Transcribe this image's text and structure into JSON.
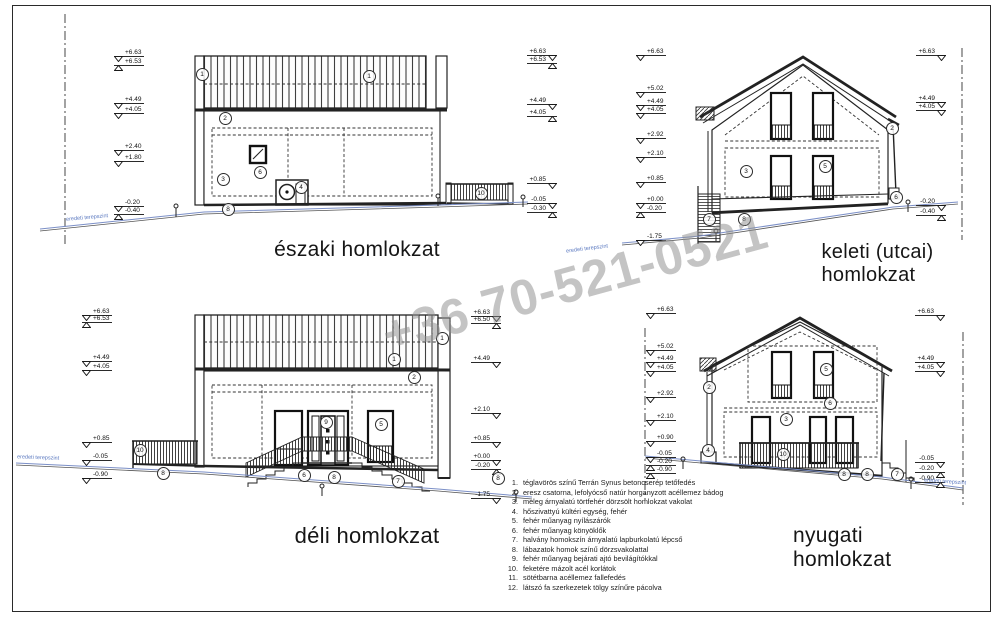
{
  "watermark": {
    "text": "+36 70-521-0521"
  },
  "ground_label": "eredeti terepszint",
  "elevations": [
    {
      "id": "eszaki",
      "label": "északi homlokzat",
      "levels_left": [
        {
          "v": "+6.63",
          "t": "d",
          "y": 47
        },
        {
          "v": "+6.53",
          "t": "u",
          "y": 56
        },
        {
          "v": "+4.49",
          "t": "d",
          "y": 94
        },
        {
          "v": "+4.05",
          "t": "d",
          "y": 104
        },
        {
          "v": "+2.40",
          "t": "d",
          "y": 141
        },
        {
          "v": "+1.80",
          "t": "d",
          "y": 152
        },
        {
          "v": "-0.20",
          "t": "d",
          "y": 197
        },
        {
          "v": "-0.40",
          "t": "u",
          "y": 205
        }
      ],
      "levels_right": [
        {
          "v": "+6.63",
          "t": "d",
          "y": 46
        },
        {
          "v": "+6.53",
          "t": "u",
          "y": 54
        },
        {
          "v": "+4.49",
          "t": "d",
          "y": 95
        },
        {
          "v": "+4.05",
          "t": "u",
          "y": 107
        },
        {
          "v": "+0.85",
          "t": "d",
          "y": 174
        },
        {
          "v": "-0.05",
          "t": "d",
          "y": 194
        },
        {
          "v": "-0.30",
          "t": "u",
          "y": 203
        }
      ],
      "callouts": [
        {
          "n": "1",
          "x": 201,
          "y": 73
        },
        {
          "n": "1",
          "x": 368,
          "y": 75
        },
        {
          "n": "2",
          "x": 224,
          "y": 117
        },
        {
          "n": "6",
          "x": 259,
          "y": 171
        },
        {
          "n": "3",
          "x": 222,
          "y": 178
        },
        {
          "n": "4",
          "x": 300,
          "y": 186
        },
        {
          "n": "8",
          "x": 227,
          "y": 208
        },
        {
          "n": "10",
          "x": 480,
          "y": 192
        }
      ]
    },
    {
      "id": "keleti",
      "label": "keleti (utcai) homlokzat",
      "levels_left": [
        {
          "v": "+6.63",
          "t": "d",
          "y": 46
        },
        {
          "v": "+5.02",
          "t": "d",
          "y": 83
        },
        {
          "v": "+4.49",
          "t": "d",
          "y": 96
        },
        {
          "v": "+4.05",
          "t": "d",
          "y": 104
        },
        {
          "v": "+2.92",
          "t": "d",
          "y": 129
        },
        {
          "v": "+2.10",
          "t": "d",
          "y": 148
        },
        {
          "v": "+0.85",
          "t": "d",
          "y": 173
        },
        {
          "v": "+0.00",
          "t": "d",
          "y": 194
        },
        {
          "v": "-0.20",
          "t": "u",
          "y": 203
        },
        {
          "v": "-1.75",
          "t": "d",
          "y": 231
        }
      ],
      "levels_right": [
        {
          "v": "+6.63",
          "t": "d",
          "y": 46
        },
        {
          "v": "+4.49",
          "t": "d",
          "y": 93
        },
        {
          "v": "+4.05",
          "t": "d",
          "y": 101
        },
        {
          "v": "-0.20",
          "t": "d",
          "y": 196
        },
        {
          "v": "-0.40",
          "t": "u",
          "y": 206
        }
      ],
      "callouts": [
        {
          "n": "2",
          "x": 891,
          "y": 127
        },
        {
          "n": "3",
          "x": 745,
          "y": 170
        },
        {
          "n": "5",
          "x": 824,
          "y": 165
        },
        {
          "n": "6",
          "x": 895,
          "y": 196
        },
        {
          "n": "7",
          "x": 708,
          "y": 218
        },
        {
          "n": "8",
          "x": 743,
          "y": 218
        }
      ]
    },
    {
      "id": "deli",
      "label": "déli homlokzat",
      "levels_left": [
        {
          "v": "+6.63",
          "t": "d",
          "y": 306
        },
        {
          "v": "+6.53",
          "t": "u",
          "y": 313
        },
        {
          "v": "+4.49",
          "t": "d",
          "y": 352
        },
        {
          "v": "+4.05",
          "t": "d",
          "y": 361
        },
        {
          "v": "+0.85",
          "t": "d",
          "y": 433
        },
        {
          "v": "-0.05",
          "t": "d",
          "y": 451
        },
        {
          "v": "-0.90",
          "t": "d",
          "y": 469
        }
      ],
      "levels_right": [
        {
          "v": "+6.63",
          "t": "d",
          "y": 307
        },
        {
          "v": "+6.50",
          "t": "u",
          "y": 314
        },
        {
          "v": "+4.49",
          "t": "d",
          "y": 353
        },
        {
          "v": "+2.10",
          "t": "d",
          "y": 404
        },
        {
          "v": "+0.85",
          "t": "d",
          "y": 433
        },
        {
          "v": "+0.00",
          "t": "d",
          "y": 451
        },
        {
          "v": "-0.20",
          "t": "u",
          "y": 460
        },
        {
          "v": "-1.75",
          "t": "d",
          "y": 489
        }
      ],
      "callouts": [
        {
          "n": "1",
          "x": 441,
          "y": 337
        },
        {
          "n": "1",
          "x": 393,
          "y": 358
        },
        {
          "n": "2",
          "x": 413,
          "y": 376
        },
        {
          "n": "9",
          "x": 325,
          "y": 421
        },
        {
          "n": "5",
          "x": 380,
          "y": 423
        },
        {
          "n": "6",
          "x": 303,
          "y": 474
        },
        {
          "n": "10",
          "x": 139,
          "y": 449
        },
        {
          "n": "8",
          "x": 162,
          "y": 472
        },
        {
          "n": "8",
          "x": 333,
          "y": 476
        },
        {
          "n": "8",
          "x": 497,
          "y": 477
        },
        {
          "n": "7",
          "x": 397,
          "y": 480
        }
      ]
    },
    {
      "id": "nyugati",
      "label": "nyugati homlokzat",
      "levels_left": [
        {
          "v": "+6.63",
          "t": "d",
          "y": 304
        },
        {
          "v": "+5.02",
          "t": "d",
          "y": 341
        },
        {
          "v": "+4.49",
          "t": "d",
          "y": 353
        },
        {
          "v": "+4.05",
          "t": "d",
          "y": 362
        },
        {
          "v": "+2.92",
          "t": "d",
          "y": 388
        },
        {
          "v": "+2.10",
          "t": "d",
          "y": 411
        },
        {
          "v": "+0.90",
          "t": "d",
          "y": 432
        },
        {
          "v": "-0.05",
          "t": "d",
          "y": 448
        },
        {
          "v": "-0.20",
          "t": "u",
          "y": 456
        },
        {
          "v": "-0.90",
          "t": "u",
          "y": 464
        }
      ],
      "levels_right": [
        {
          "v": "+6.63",
          "t": "d",
          "y": 306
        },
        {
          "v": "+4.49",
          "t": "d",
          "y": 353
        },
        {
          "v": "+4.05",
          "t": "d",
          "y": 362
        },
        {
          "v": "-0.05",
          "t": "d",
          "y": 453
        },
        {
          "v": "-0.20",
          "t": "u",
          "y": 463
        },
        {
          "v": "-0.90",
          "t": "u",
          "y": 473
        }
      ],
      "callouts": [
        {
          "n": "2",
          "x": 708,
          "y": 386
        },
        {
          "n": "5",
          "x": 825,
          "y": 368
        },
        {
          "n": "6",
          "x": 829,
          "y": 402
        },
        {
          "n": "3",
          "x": 785,
          "y": 418
        },
        {
          "n": "4",
          "x": 707,
          "y": 449
        },
        {
          "n": "10",
          "x": 782,
          "y": 453
        },
        {
          "n": "8",
          "x": 843,
          "y": 473
        },
        {
          "n": "8",
          "x": 866,
          "y": 473
        },
        {
          "n": "7",
          "x": 896,
          "y": 473
        }
      ]
    }
  ],
  "legend": {
    "items": [
      {
        "num": "1.",
        "text": "téglavörös színű Terrán Synus betoncserép tetőfedés"
      },
      {
        "num": "2.",
        "text": "eresz csatorna, lefolyócső  natúr horganyzott acéllemez bádog"
      },
      {
        "num": "3.",
        "text": "meleg árnyalatú törtfehér dörzsölt homlokzat vakolat"
      },
      {
        "num": "4.",
        "text": "hőszivattyú kültéri egység, fehér"
      },
      {
        "num": "5.",
        "text": "fehér műanyag nyílászárók"
      },
      {
        "num": "6.",
        "text": "fehér műanyag könyöklők"
      },
      {
        "num": "7.",
        "text": "halvány homokszín árnyalatú lapburkolatú lépcső"
      },
      {
        "num": "8.",
        "text": "lábazatok homok színű dörzsvakolattal"
      },
      {
        "num": "9.",
        "text": "fehér műanyag bejárati ajtó bevilágítókkal"
      },
      {
        "num": "10.",
        "text": "feketére mázolt acél korlátok"
      },
      {
        "num": "11.",
        "text": "sötétbarna acéllemez fallefedés"
      },
      {
        "num": "12.",
        "text": "látszó fa szerkezetek tölgy színűre pácolva"
      }
    ]
  }
}
